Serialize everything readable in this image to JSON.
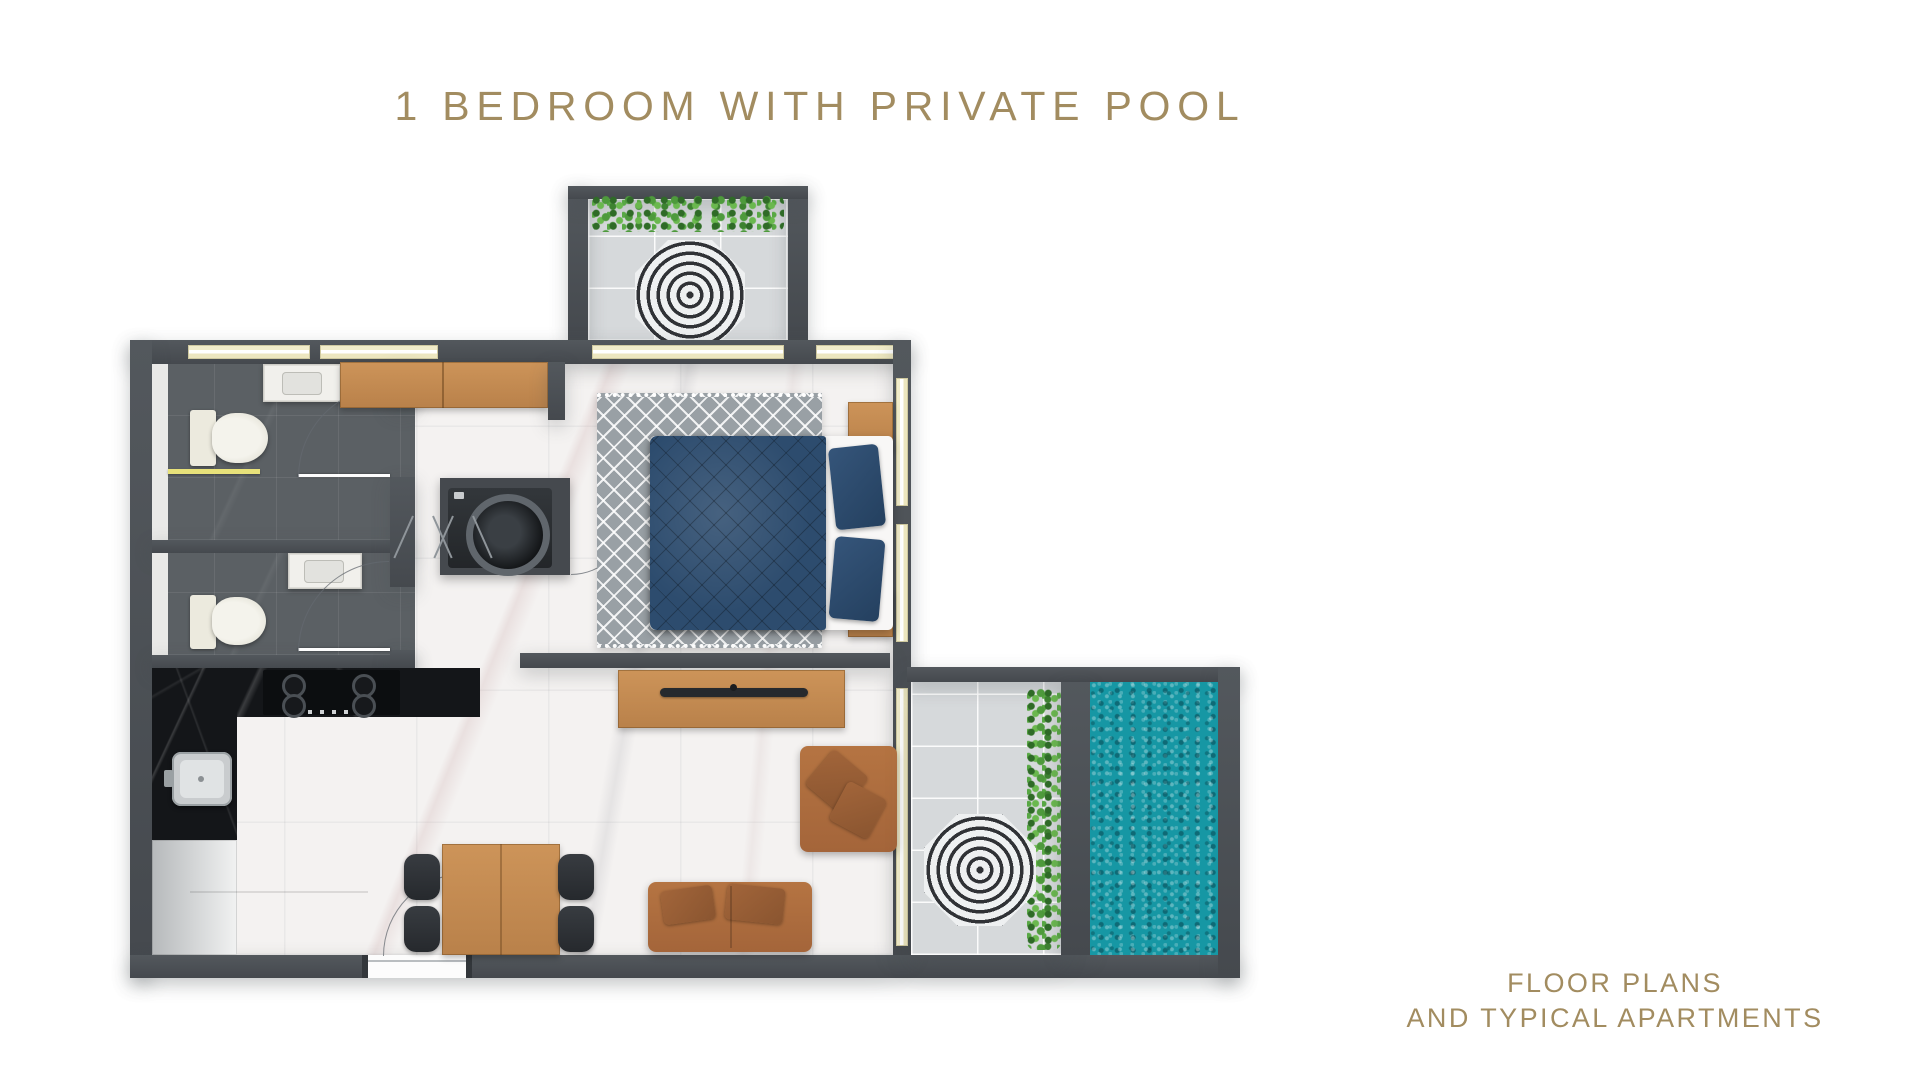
{
  "title": "1 BEDROOM WITH PRIVATE POOL",
  "footer": {
    "line1": "FLOOR PLANS",
    "line2": "AND TYPICAL APARTMENTS"
  },
  "colors": {
    "accent_gold": "#A28C60",
    "wall": "#4A4E53",
    "marble_floor": "#F4F2F1",
    "light_tile": "#D6D9DB",
    "dark_bath_tile": "#5B6064",
    "black_counter": "#141619",
    "wood": "#C58D55",
    "navy_bed": "#2D4C6E",
    "rug_gray": "#99A0A5",
    "sofa_brown": "#AD6B3E",
    "pool_teal": "#1697A4",
    "hedge_green": "#4E9A3C",
    "window_cream": "#F1ECCA"
  },
  "plan": {
    "rooms": [
      "balcony",
      "bedroom",
      "hallway",
      "bathroom-1",
      "bathroom-2",
      "kitchen",
      "living-dining-room",
      "terrace",
      "private-pool"
    ],
    "elements": [
      "balcony-hedge",
      "balcony-umbrella",
      "window-strip",
      "wardrobe",
      "washing-machine-closet",
      "washing-machine",
      "double-bed",
      "bedroom-rug",
      "nightstand-top",
      "nightstand-bottom",
      "navy-pillows",
      "toilet",
      "vanity-sink",
      "shower-glass-screen",
      "bathroom-door",
      "kitchen-counter",
      "cooktop-4-burner",
      "kitchen-sink",
      "kitchen-cabinet",
      "tv-console",
      "tv",
      "partition-wall",
      "dining-table",
      "dining-chair",
      "sofa",
      "lounge-chair",
      "entrance-door",
      "sliding-glass-door",
      "terrace-umbrella",
      "terrace-hedge",
      "pool-water"
    ]
  }
}
